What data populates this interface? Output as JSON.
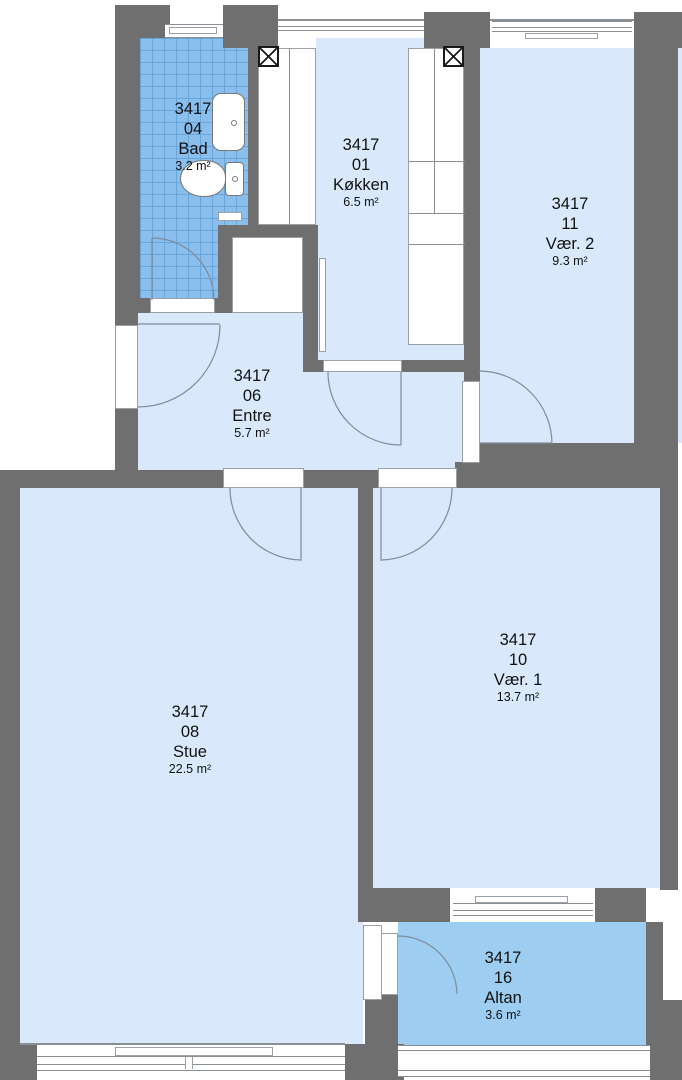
{
  "plan": {
    "project": "3417",
    "rooms": [
      {
        "id": "04",
        "name": "Bad",
        "area": "3.2 m²"
      },
      {
        "id": "01",
        "name": "Køkken",
        "area": "6.5 m²"
      },
      {
        "id": "11",
        "name": "Vær. 2",
        "area": "9.3 m²"
      },
      {
        "id": "06",
        "name": "Entre",
        "area": "5.7 m²"
      },
      {
        "id": "08",
        "name": "Stue",
        "area": "22.5 m²"
      },
      {
        "id": "10",
        "name": "Vær. 1",
        "area": "13.7 m²"
      },
      {
        "id": "16",
        "name": "Altan",
        "area": "3.6 m²"
      }
    ],
    "colors": {
      "wall": "#6f6f6f",
      "room": "#d9e9fb",
      "wet": "#8abeed",
      "tile": "#68a6da",
      "balcony": "#9ecdf2"
    }
  }
}
